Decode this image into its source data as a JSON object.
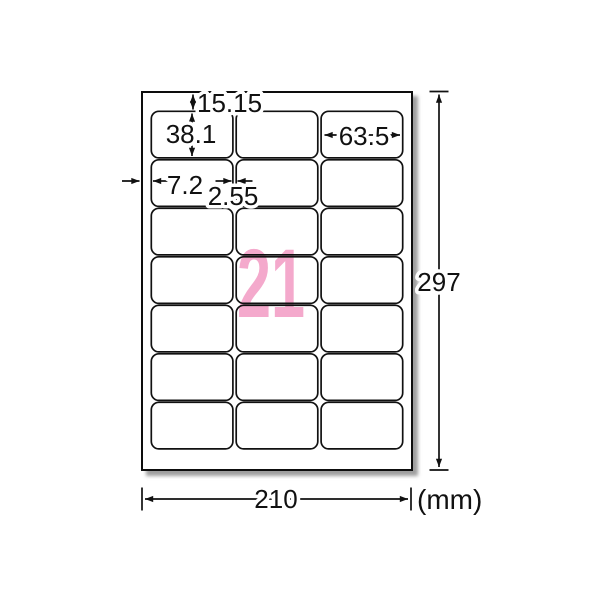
{
  "diagram": {
    "description": "A4 label sheet dimension diagram, 21 labels (3 columns x 7 rows)",
    "unit": "(mm)",
    "big_count": "21",
    "sheet": {
      "columns": 3,
      "rows": 7
    },
    "dims": {
      "top_margin": "15.15",
      "label_height": "38.1",
      "label_width": "63.5",
      "side_margin": "7.2",
      "column_gap": "2.55",
      "sheet_width": "210",
      "sheet_height": "297"
    },
    "colors": {
      "count_pink": "#F4A9CC",
      "line": "#111111",
      "paper": "#ffffff",
      "shadow": "#8d8d8d"
    }
  }
}
